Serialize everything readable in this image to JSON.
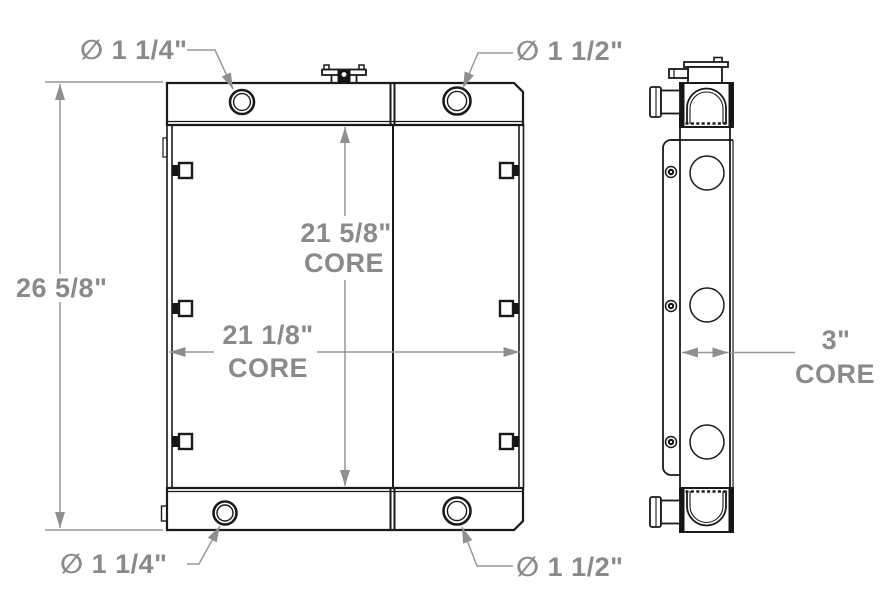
{
  "drawing": {
    "labels": {
      "port_top_left": "∅ 1 1/4\"",
      "port_top_right": "∅ 1 1/2\"",
      "port_bottom_left": "∅ 1 1/4\"",
      "port_bottom_right": "∅ 1 1/2\"",
      "overall_height": "26 5/8\"",
      "core_height_value": "21 5/8\"",
      "core_height_word": "CORE",
      "core_width_value": "21 1/8\"",
      "core_width_word": "CORE",
      "core_depth_value": "3\"",
      "core_depth_word": "CORE"
    },
    "colors": {
      "line": "#1a1a1a",
      "dimension": "#989898",
      "text": "#8a8a8a",
      "background": "#ffffff"
    }
  }
}
